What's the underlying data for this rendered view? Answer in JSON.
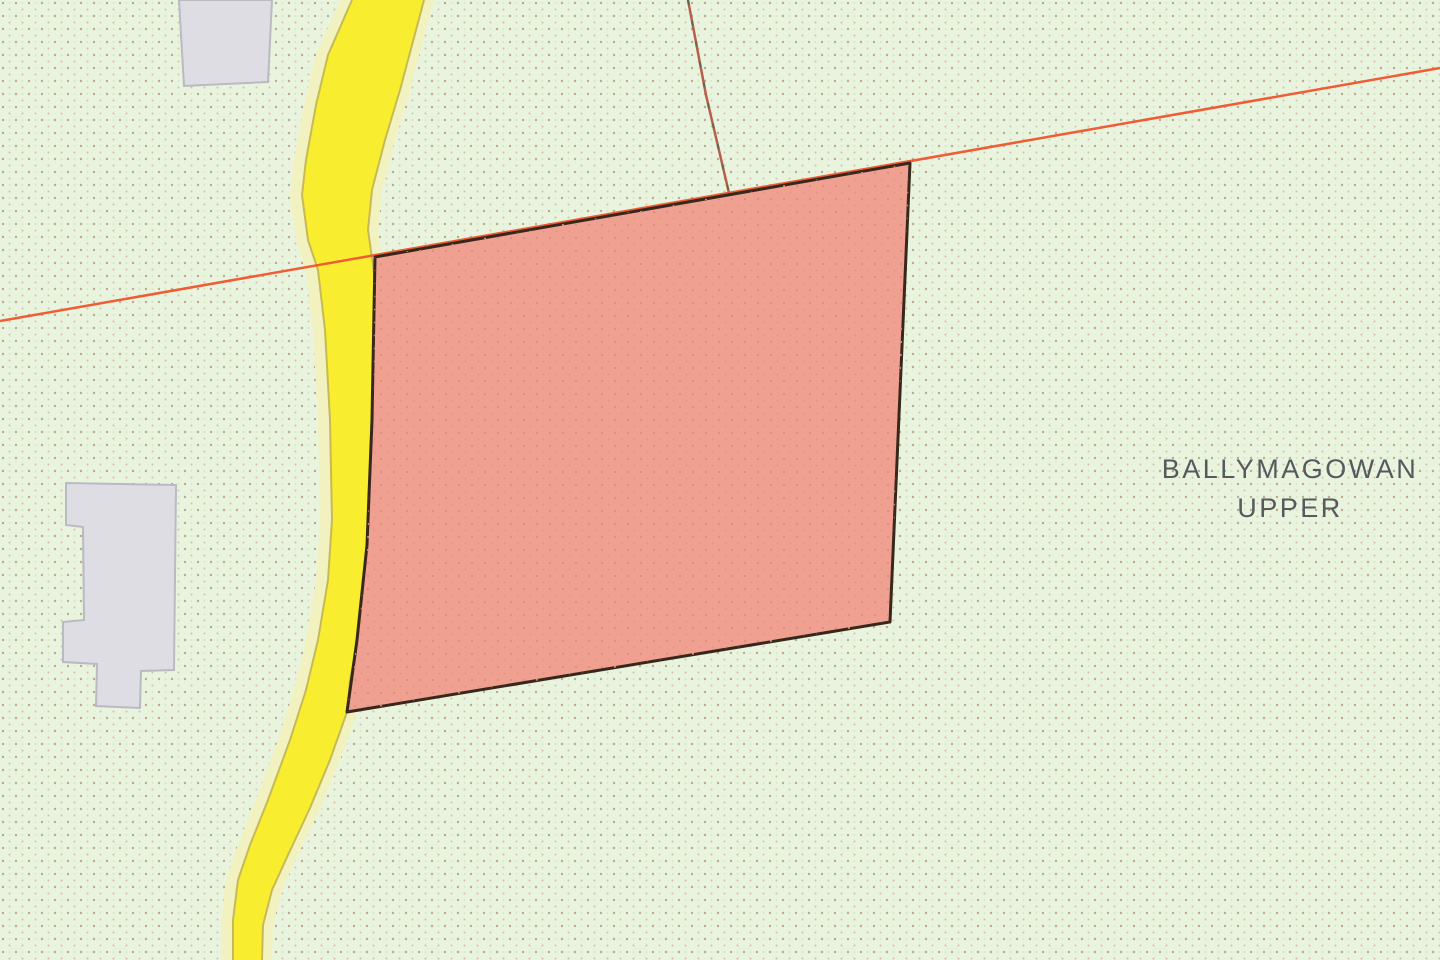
{
  "map": {
    "townland_label": {
      "line1": "BALLYMAGOWAN",
      "line2": "UPPER"
    },
    "colors": {
      "background": "#e9f4de",
      "dot_a": "#bda890",
      "dot_b": "#d9b2a2",
      "dot_c": "#cfe0bc",
      "road_fill": "#f8ee2f",
      "road_casing": "#f2f2c0",
      "road_edge": "#c6ba58",
      "parcel_fill": "#efa091",
      "parcel_dot": "#de8d7d",
      "parcel_border": "#38281b",
      "boundary_line": "#f05c35",
      "field_line": "#b75f4b",
      "field_line_dash": "#5f6a4e",
      "building_fill": "#dddde3",
      "building_border": "#b9bac2",
      "label_color": "#555a5e"
    }
  }
}
